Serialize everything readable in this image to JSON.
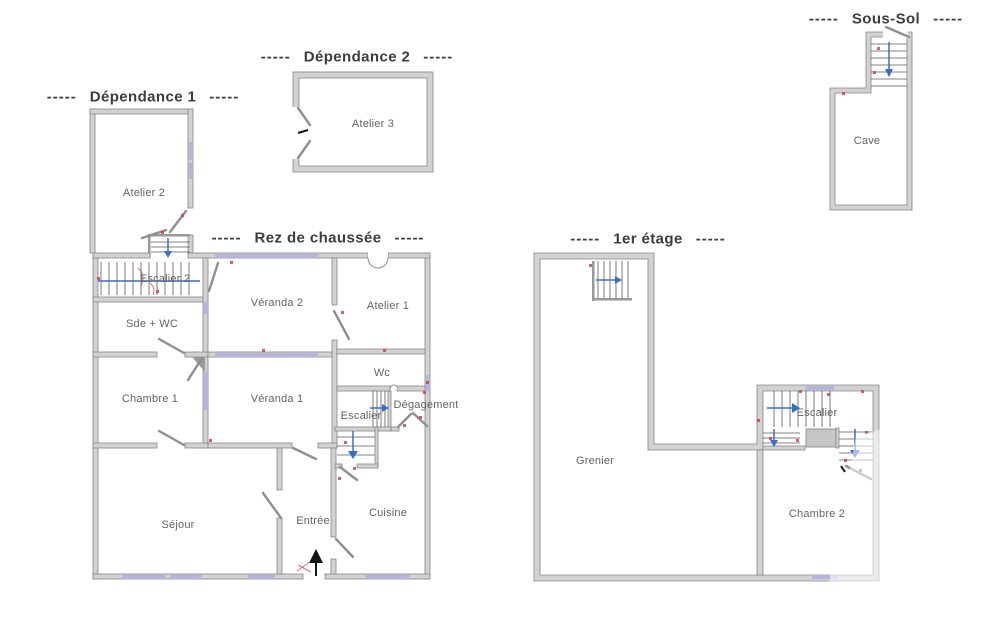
{
  "plan": {
    "dash": "-----",
    "sections": {
      "dependance1": {
        "title": "Dépendance 1"
      },
      "dependance2": {
        "title": "Dépendance 2"
      },
      "rez_de_chaussee": {
        "title": "Rez de chaussée"
      },
      "premier_etage": {
        "title": "1er étage"
      },
      "sous_sol": {
        "title": "Sous-Sol"
      }
    },
    "rooms": {
      "atelier2": "Atelier 2",
      "escalier2": "Escalier 2",
      "sde_wc": "Sde + WC",
      "chambre1": "Chambre 1",
      "veranda2": "Véranda 2",
      "veranda1": "Véranda 1",
      "atelier1": "Atelier 1",
      "wc": "Wc",
      "escalier_rdc": "Escalier",
      "degagement": "Dégagement",
      "sejour": "Séjour",
      "entree": "Entrée",
      "cuisine": "Cuisine",
      "atelier3": "Atelier 3",
      "cave": "Cave",
      "grenier": "Grenier",
      "escalier_etage": "Escalier",
      "chambre2": "Chambre 2"
    },
    "colors": {
      "wall_fill": "#d2d2d2",
      "wall_edge": "#868686",
      "window": "#b4b4de",
      "stair_arrow_blue": "#3a6cc8",
      "annotation_red": "#cc3a3a",
      "label_text": "#636363",
      "title_text": "#3c3c3c"
    }
  }
}
